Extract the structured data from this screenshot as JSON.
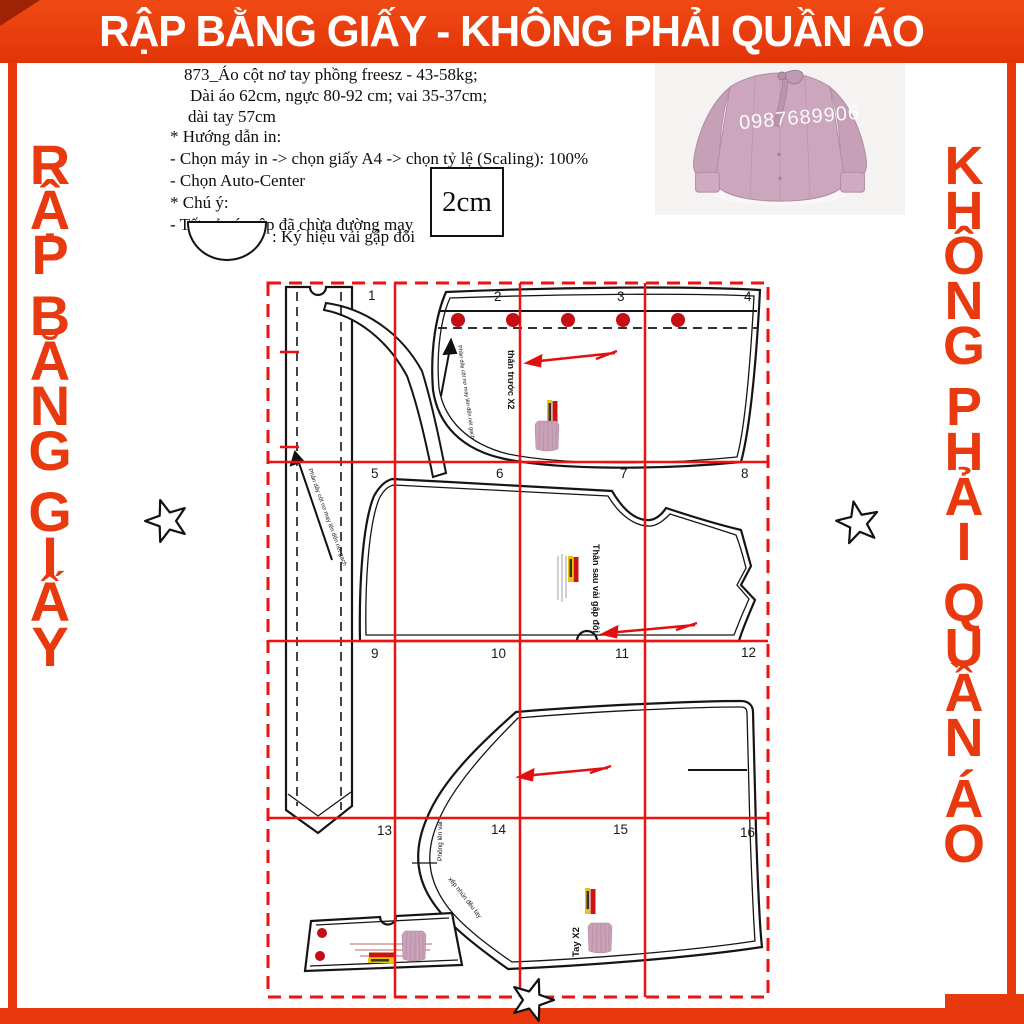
{
  "banner": {
    "title": "RẬP BẰNG GIẤY - KHÔNG PHẢI QUẦN ÁO"
  },
  "side": {
    "left": "RẬP BẰNG GIẤY",
    "right": "KHÔNG PHẢI QUẦN ÁO"
  },
  "product": {
    "lines": [
      "873_Áo cột nơ tay phồng freesz - 43-58kg;",
      "Dài áo 62cm, ngực 80-92 cm; vai 35-37cm;",
      "dài tay 57cm"
    ]
  },
  "instructions": {
    "lines": [
      "* Hướng dẫn in:",
      "- Chọn máy in -> chọn giấy A4  -> chọn tỷ lệ (Scaling): 100%",
      "- Chọn Auto-Center",
      "* Chú ý:",
      "- Tất cả các rập đã chừa đường may"
    ]
  },
  "scale_box": {
    "label": "2cm"
  },
  "fold_legend": {
    "label": ": Ký hiệu vải gập đôi"
  },
  "photo": {
    "watermark": "0987689906"
  },
  "pattern": {
    "page_numbers": [
      "1",
      "2",
      "3",
      "4",
      "5",
      "6",
      "7",
      "8",
      "9",
      "10",
      "11",
      "12",
      "13",
      "14",
      "15",
      "16"
    ],
    "labels": {
      "front_piece": "thân trước X2",
      "back_piece": "Thân sau vải gập đôi",
      "sleeve_piece": "Tay X2",
      "sleeve_shoulder_note": "Phồng lên vai",
      "sleeve_gather_note": "xếp nhún đều tay",
      "strap_note": "Phần dây cột nơ may lên đến nét gạch",
      "strap_note_2": "Phần dây cột nơ may lên đến nét gạch"
    }
  },
  "colors": {
    "accent_red": "#e8380e",
    "grid_red": "#ee1111",
    "button_red": "#c40d15",
    "blouse_pink": "#c9a4ba"
  }
}
